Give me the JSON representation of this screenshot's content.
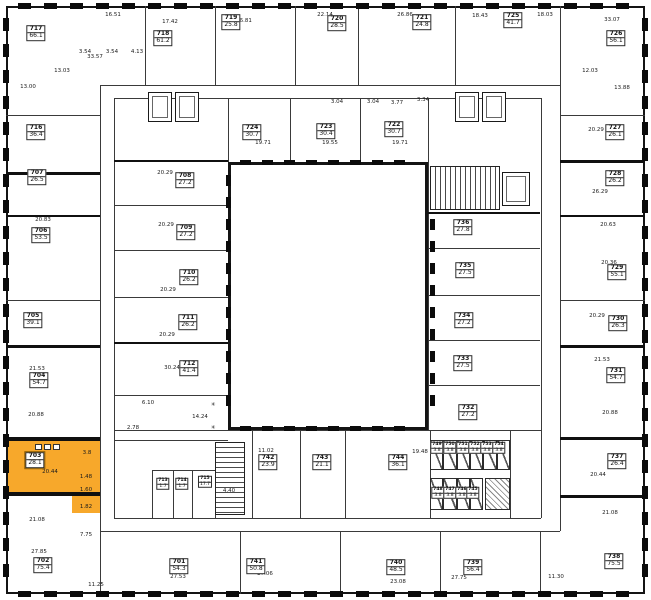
{
  "plan": {
    "type": "architectural-floor-plan",
    "highlight_color": "#F7A82B",
    "wall_color": "#141414",
    "bg_color": "#ffffff",
    "highlighted_unit": {
      "id": "703",
      "area": "28.1"
    }
  },
  "units": [
    {
      "id": "717",
      "area": "66.1",
      "x": 36,
      "y": 33
    },
    {
      "id": "718",
      "area": "61.2",
      "x": 163,
      "y": 38
    },
    {
      "id": "719",
      "area": "25.8",
      "x": 231,
      "y": 22
    },
    {
      "id": "720",
      "area": "28.5",
      "x": 337,
      "y": 23
    },
    {
      "id": "721",
      "area": "24.8",
      "x": 422,
      "y": 22
    },
    {
      "id": "725",
      "area": "41.7",
      "x": 513,
      "y": 20
    },
    {
      "id": "726",
      "area": "56.1",
      "x": 616,
      "y": 38
    },
    {
      "id": "716",
      "area": "36.4",
      "x": 36,
      "y": 132
    },
    {
      "id": "707",
      "area": "26.5",
      "x": 37,
      "y": 177
    },
    {
      "id": "706",
      "area": "53.5",
      "x": 41,
      "y": 235
    },
    {
      "id": "705",
      "area": "39.1",
      "x": 33,
      "y": 320
    },
    {
      "id": "704",
      "area": "54.7",
      "x": 39,
      "y": 380
    },
    {
      "id": "703",
      "area": "28.1",
      "x": 35,
      "y": 460,
      "highlight": true
    },
    {
      "id": "702",
      "area": "75.4",
      "x": 43,
      "y": 565
    },
    {
      "id": "727",
      "area": "26.1",
      "x": 615,
      "y": 132
    },
    {
      "id": "728",
      "area": "26.2",
      "x": 615,
      "y": 178
    },
    {
      "id": "729",
      "area": "55.1",
      "x": 617,
      "y": 272
    },
    {
      "id": "730",
      "area": "26.3",
      "x": 618,
      "y": 323
    },
    {
      "id": "731",
      "area": "54.7",
      "x": 616,
      "y": 375
    },
    {
      "id": "737",
      "area": "26.4",
      "x": 617,
      "y": 461
    },
    {
      "id": "738",
      "area": "75.5",
      "x": 614,
      "y": 561
    },
    {
      "id": "701",
      "area": "54.3",
      "x": 179,
      "y": 566
    },
    {
      "id": "741",
      "area": "50.8",
      "x": 256,
      "y": 566
    },
    {
      "id": "740",
      "area": "48.5",
      "x": 396,
      "y": 567
    },
    {
      "id": "739",
      "area": "56.4",
      "x": 473,
      "y": 567
    },
    {
      "id": "724",
      "area": "30.7",
      "x": 252,
      "y": 132
    },
    {
      "id": "723",
      "area": "30.4",
      "x": 326,
      "y": 131
    },
    {
      "id": "722",
      "area": "30.7",
      "x": 394,
      "y": 129
    },
    {
      "id": "708",
      "area": "27.2",
      "x": 185,
      "y": 180
    },
    {
      "id": "709",
      "area": "27.2",
      "x": 186,
      "y": 232
    },
    {
      "id": "710",
      "area": "26.2",
      "x": 189,
      "y": 277
    },
    {
      "id": "711",
      "area": "26.2",
      "x": 188,
      "y": 322
    },
    {
      "id": "712",
      "area": "41.4",
      "x": 189,
      "y": 368
    },
    {
      "id": "736",
      "area": "27.8",
      "x": 463,
      "y": 227
    },
    {
      "id": "735",
      "area": "27.5",
      "x": 465,
      "y": 270
    },
    {
      "id": "734",
      "area": "27.2",
      "x": 464,
      "y": 320
    },
    {
      "id": "733",
      "area": "27.5",
      "x": 463,
      "y": 363
    },
    {
      "id": "732",
      "area": "27.2",
      "x": 468,
      "y": 412
    },
    {
      "id": "742",
      "area": "23.9",
      "x": 268,
      "y": 462
    },
    {
      "id": "743",
      "area": "21.1",
      "x": 322,
      "y": 462
    },
    {
      "id": "744",
      "area": "36.1",
      "x": 398,
      "y": 462
    },
    {
      "id": "713",
      "area": "1.7",
      "x": 163,
      "y": 484,
      "small": true
    },
    {
      "id": "714",
      "area": "1.7",
      "x": 182,
      "y": 484,
      "small": true
    },
    {
      "id": "715",
      "area": "17.7",
      "x": 205,
      "y": 482,
      "small": true
    },
    {
      "id": "749",
      "area": "3.8",
      "x": 437,
      "y": 448,
      "small": true
    },
    {
      "id": "750",
      "area": "3.8",
      "x": 450,
      "y": 448,
      "small": true
    },
    {
      "id": "751",
      "area": "3.8",
      "x": 463,
      "y": 448,
      "small": true
    },
    {
      "id": "752",
      "area": "3.8",
      "x": 475,
      "y": 448,
      "small": true
    },
    {
      "id": "753",
      "area": "3.8",
      "x": 487,
      "y": 448,
      "small": true
    },
    {
      "id": "754",
      "area": "3.8",
      "x": 499,
      "y": 448,
      "small": true
    },
    {
      "id": "748",
      "area": "3.8",
      "x": 438,
      "y": 493,
      "small": true
    },
    {
      "id": "747",
      "area": "3.8",
      "x": 450,
      "y": 493,
      "small": true
    },
    {
      "id": "746",
      "area": "3.8",
      "x": 462,
      "y": 493,
      "small": true
    },
    {
      "id": "745",
      "area": "3.8",
      "x": 473,
      "y": 493,
      "small": true
    }
  ],
  "area_texts": [
    {
      "t": "33.57",
      "x": 95,
      "y": 57
    },
    {
      "t": "16.51",
      "x": 113,
      "y": 15
    },
    {
      "t": "17.42",
      "x": 170,
      "y": 22
    },
    {
      "t": "26.81",
      "x": 244,
      "y": 21
    },
    {
      "t": "22.14",
      "x": 325,
      "y": 15
    },
    {
      "t": "26.86",
      "x": 405,
      "y": 15
    },
    {
      "t": "18.43",
      "x": 480,
      "y": 16
    },
    {
      "t": "18.03",
      "x": 545,
      "y": 15
    },
    {
      "t": "33.07",
      "x": 612,
      "y": 20
    },
    {
      "t": "13.03",
      "x": 62,
      "y": 71
    },
    {
      "t": "13.00",
      "x": 28,
      "y": 87
    },
    {
      "t": "3.54",
      "x": 85,
      "y": 52
    },
    {
      "t": "3.54",
      "x": 112,
      "y": 52
    },
    {
      "t": "4.13",
      "x": 137,
      "y": 52
    },
    {
      "t": "3.04",
      "x": 337,
      "y": 102
    },
    {
      "t": "3.04",
      "x": 373,
      "y": 102
    },
    {
      "t": "3.77",
      "x": 397,
      "y": 103
    },
    {
      "t": "3.34",
      "x": 423,
      "y": 100
    },
    {
      "t": "12.03",
      "x": 590,
      "y": 71
    },
    {
      "t": "13.88",
      "x": 622,
      "y": 88
    },
    {
      "t": "19.71",
      "x": 263,
      "y": 143
    },
    {
      "t": "19.55",
      "x": 330,
      "y": 143
    },
    {
      "t": "19.71",
      "x": 400,
      "y": 143
    },
    {
      "t": "20.29",
      "x": 165,
      "y": 173
    },
    {
      "t": "20.29",
      "x": 166,
      "y": 225
    },
    {
      "t": "20.29",
      "x": 168,
      "y": 290
    },
    {
      "t": "20.29",
      "x": 167,
      "y": 335
    },
    {
      "t": "30.24",
      "x": 172,
      "y": 368
    },
    {
      "t": "6.10",
      "x": 148,
      "y": 403
    },
    {
      "t": "2.78",
      "x": 133,
      "y": 428
    },
    {
      "t": "14.24",
      "x": 200,
      "y": 417
    },
    {
      "t": "✳",
      "x": 213,
      "y": 405
    },
    {
      "t": "✳",
      "x": 213,
      "y": 428
    },
    {
      "t": "20.83",
      "x": 43,
      "y": 220
    },
    {
      "t": "21.53",
      "x": 37,
      "y": 369
    },
    {
      "t": "20.88",
      "x": 36,
      "y": 415
    },
    {
      "t": "20.44",
      "x": 50,
      "y": 472
    },
    {
      "t": "3.8",
      "x": 87,
      "y": 453
    },
    {
      "t": "1.48",
      "x": 86,
      "y": 477
    },
    {
      "t": "1.60",
      "x": 86,
      "y": 490
    },
    {
      "t": "1.82",
      "x": 86,
      "y": 507
    },
    {
      "t": "21.08",
      "x": 37,
      "y": 520
    },
    {
      "t": "27.85",
      "x": 39,
      "y": 552
    },
    {
      "t": "11.25",
      "x": 96,
      "y": 585
    },
    {
      "t": "7.75",
      "x": 86,
      "y": 535
    },
    {
      "t": "27.53",
      "x": 178,
      "y": 577
    },
    {
      "t": "27.06",
      "x": 265,
      "y": 574
    },
    {
      "t": "23.08",
      "x": 398,
      "y": 582
    },
    {
      "t": "27.75",
      "x": 459,
      "y": 578
    },
    {
      "t": "11.30",
      "x": 556,
      "y": 577
    },
    {
      "t": "20.29",
      "x": 596,
      "y": 130
    },
    {
      "t": "26.29",
      "x": 600,
      "y": 192
    },
    {
      "t": "20.63",
      "x": 608,
      "y": 225
    },
    {
      "t": "20.36",
      "x": 609,
      "y": 263
    },
    {
      "t": "20.29",
      "x": 597,
      "y": 316
    },
    {
      "t": "21.53",
      "x": 602,
      "y": 360
    },
    {
      "t": "20.88",
      "x": 610,
      "y": 413
    },
    {
      "t": "20.44",
      "x": 598,
      "y": 475
    },
    {
      "t": "21.08",
      "x": 610,
      "y": 513
    },
    {
      "t": "11.02",
      "x": 266,
      "y": 451
    },
    {
      "t": "19.48",
      "x": 420,
      "y": 452
    },
    {
      "t": "4.40",
      "x": 229,
      "y": 491
    }
  ]
}
